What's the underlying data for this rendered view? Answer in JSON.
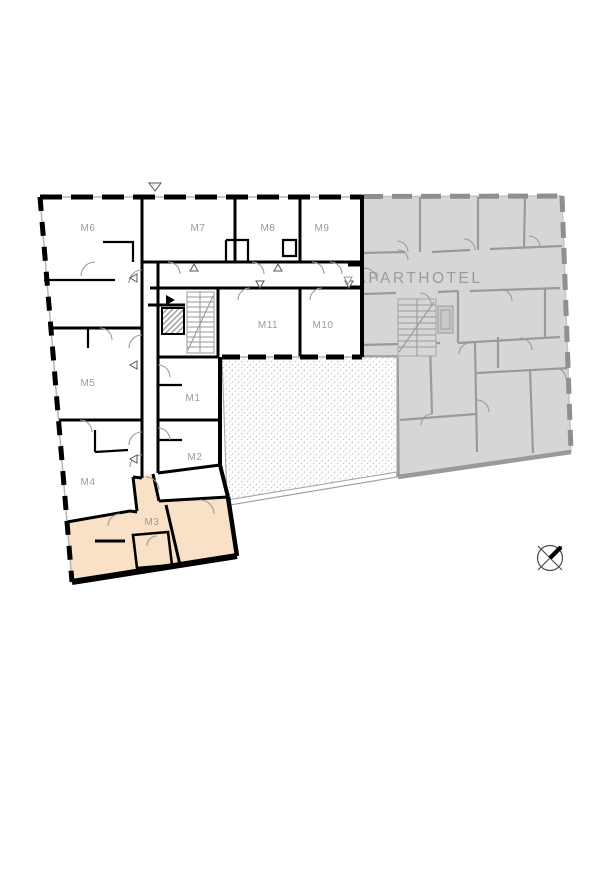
{
  "plan": {
    "aparthotel_label": "APARTHOTEL",
    "highlighted_unit_id": "M3",
    "units": [
      {
        "id": "M6",
        "label": "M6"
      },
      {
        "id": "M7",
        "label": "M7"
      },
      {
        "id": "M8",
        "label": "M8"
      },
      {
        "id": "M9",
        "label": "M9"
      },
      {
        "id": "M11",
        "label": "M11"
      },
      {
        "id": "M10",
        "label": "M10"
      },
      {
        "id": "M5",
        "label": "M5"
      },
      {
        "id": "M1",
        "label": "M1"
      },
      {
        "id": "M4",
        "label": "M4"
      },
      {
        "id": "M2",
        "label": "M2"
      },
      {
        "id": "M3",
        "label": "M3"
      }
    ],
    "colors": {
      "background": "#ffffff",
      "highlight_fill": "#f8e1c6",
      "aparthotel_fill": "#d6d6d6",
      "aparthotel_wall": "#9a9a9a",
      "wall": "#000000",
      "label_text": "#9b9b9b",
      "courtyard_dot": "#bdbdbd"
    }
  },
  "compass": {
    "type": "north-indicator"
  }
}
